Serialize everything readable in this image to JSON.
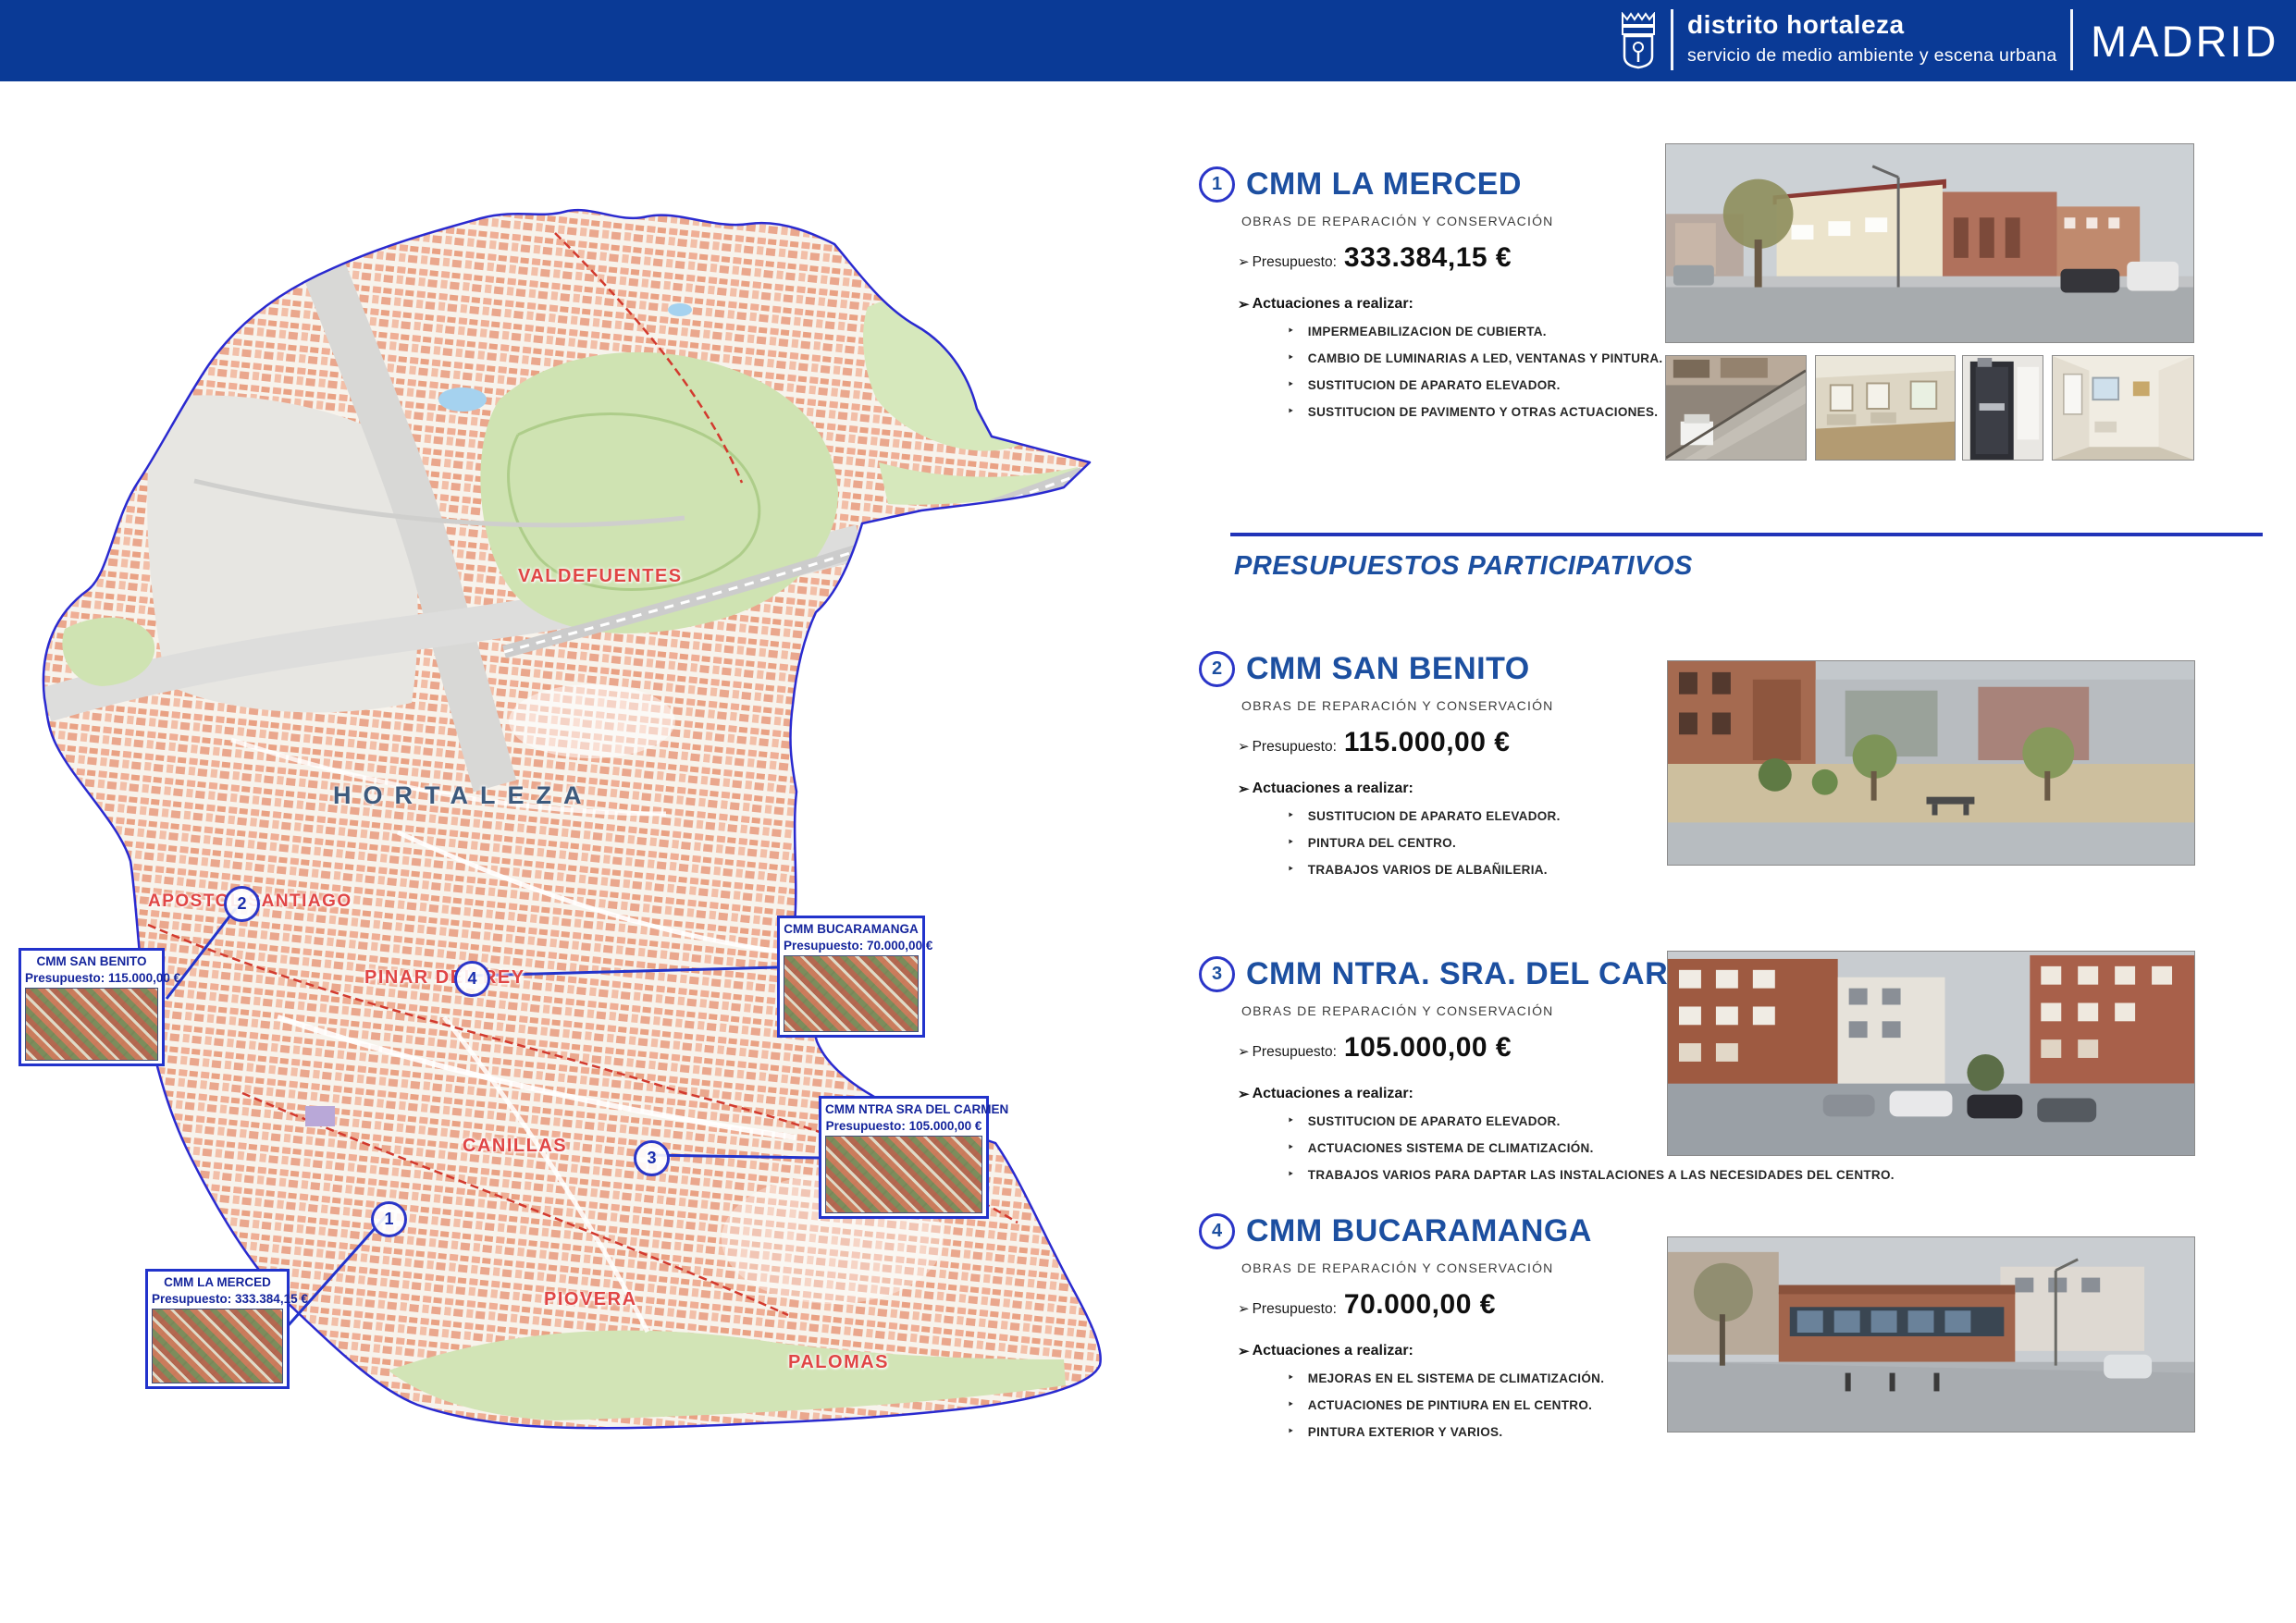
{
  "ui": {
    "arrow": "➢",
    "bullet": "‣"
  },
  "header": {
    "title": "distrito hortaleza",
    "subtitle": "servicio de medio ambiente y escena urbana",
    "brand": "MADRID"
  },
  "divider": {
    "heading": "PRESUPUESTOS PARTICIPATIVOS"
  },
  "sections": [
    {
      "number": "1",
      "title": "CMM LA MERCED",
      "works_label": "OBRAS DE REPARACIÓN Y CONSERVACIÓN",
      "budget_label": "Presupuesto:",
      "budget_amount": "333.384,15 €",
      "actions_label": "Actuaciones a realizar:",
      "actions": [
        "IMPERMEABILIZACION DE CUBIERTA.",
        "CAMBIO DE LUMINARIAS A LED, VENTANAS Y PINTURA.",
        "SUSTITUCION DE APARATO ELEVADOR.",
        "SUSTITUCION DE PAVIMENTO Y OTRAS ACTUACIONES."
      ]
    },
    {
      "number": "2",
      "title": "CMM SAN BENITO",
      "works_label": "OBRAS DE REPARACIÓN Y CONSERVACIÓN",
      "budget_label": "Presupuesto:",
      "budget_amount": "115.000,00 €",
      "actions_label": "Actuaciones a realizar:",
      "actions": [
        "SUSTITUCION DE APARATO ELEVADOR.",
        "PINTURA DEL CENTRO.",
        "TRABAJOS VARIOS DE ALBAÑILERIA."
      ]
    },
    {
      "number": "3",
      "title": "CMM NTRA. SRA. DEL CARMEN",
      "works_label": "OBRAS DE REPARACIÓN Y CONSERVACIÓN",
      "budget_label": "Presupuesto:",
      "budget_amount": "105.000,00 €",
      "actions_label": "Actuaciones a realizar:",
      "actions": [
        "SUSTITUCION DE APARATO ELEVADOR.",
        "ACTUACIONES SISTEMA DE CLIMATIZACIÓN.",
        "TRABAJOS VARIOS PARA DAPTAR LAS INSTALACIONES A LAS NECESIDADES DEL CENTRO."
      ]
    },
    {
      "number": "4",
      "title": "CMM BUCARAMANGA",
      "works_label": "OBRAS DE REPARACIÓN Y CONSERVACIÓN",
      "budget_label": "Presupuesto:",
      "budget_amount": "70.000,00 €",
      "actions_label": "Actuaciones a realizar:",
      "actions": [
        "MEJORAS EN EL SISTEMA DE CLIMATIZACIÓN.",
        "ACTUACIONES DE PINTIURA EN EL CENTRO.",
        "PINTURA  EXTERIOR Y VARIOS."
      ]
    }
  ],
  "map": {
    "district_label": "HORTALEZA",
    "area_labels": [
      {
        "text": "VALDEFUENTES"
      },
      {
        "text": "APOSTOL SANTIAGO"
      },
      {
        "text": "PINAR DEL REY"
      },
      {
        "text": "CANILLAS"
      },
      {
        "text": "PIOVERA"
      },
      {
        "text": "PALOMAS"
      }
    ],
    "markers": [
      {
        "number": "1"
      },
      {
        "number": "2"
      },
      {
        "number": "3"
      },
      {
        "number": "4"
      }
    ],
    "callouts": [
      {
        "title": "CMM SAN BENITO",
        "budget": "Presupuesto: 115.000,00 €"
      },
      {
        "title": "CMM BUCARAMANGA",
        "budget": "Presupuesto: 70.000,00 €"
      },
      {
        "title": "CMM NTRA SRA DEL CARMEN",
        "budget": "Presupuesto: 105.000,00 €"
      },
      {
        "title": "CMM LA MERCED",
        "budget": "Presupuesto: 333.384,15 €"
      }
    ],
    "colors": {
      "boundary": "#2a2ad0",
      "urban": "#efae95",
      "park": "#cfe3b2",
      "area_label": "#e04545",
      "district_label": "#3d5a7d",
      "header_blue": "#0a3a96",
      "accent_blue": "#1c4fa0"
    }
  }
}
